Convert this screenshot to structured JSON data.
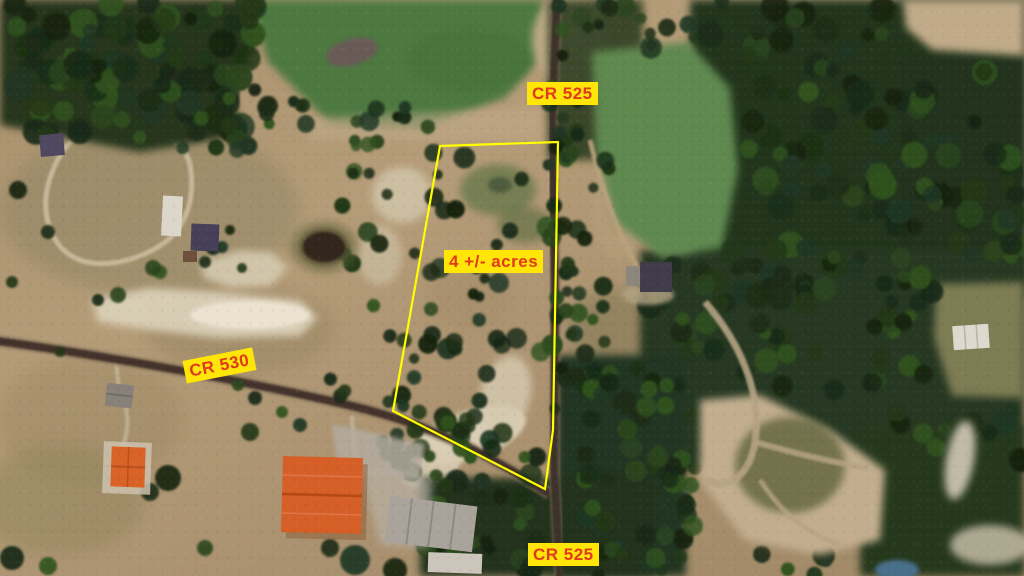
{
  "map_annotations": {
    "road_label_top": "CR 525",
    "road_label_bottom": "CR 525",
    "road_label_left": "CR 530",
    "parcel_label": "4 +/- acres"
  },
  "style": {
    "label_background": "#ffe608",
    "label_text_color": "#e2391d",
    "parcel_outline_color": "#ffff00"
  }
}
